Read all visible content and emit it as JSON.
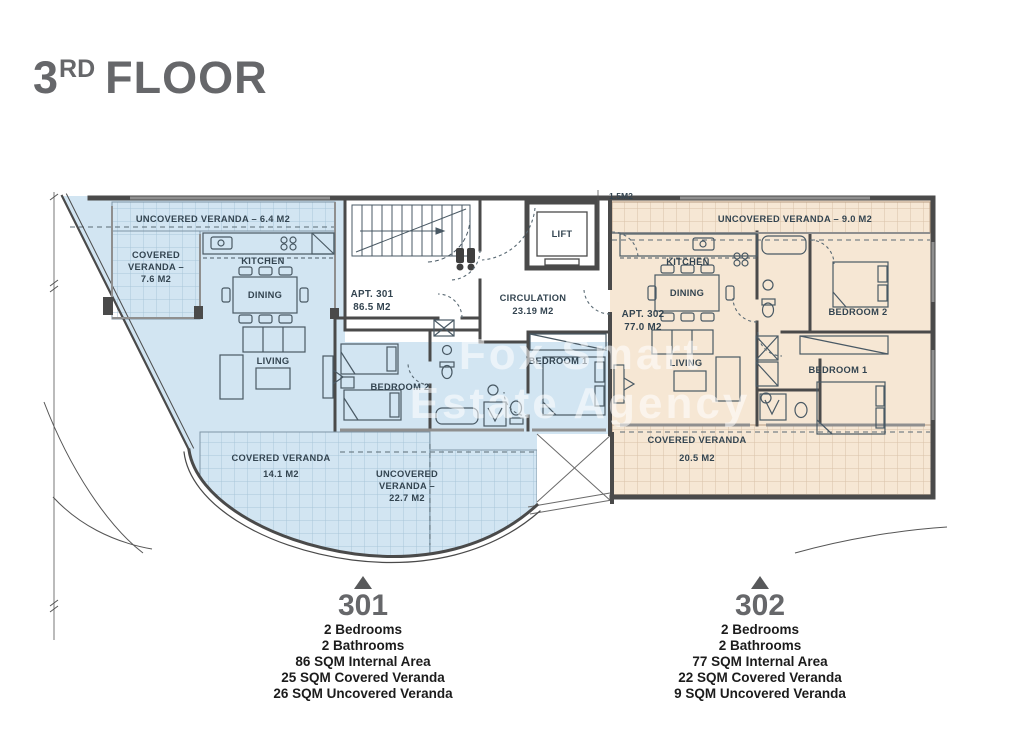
{
  "title": {
    "number": "3",
    "ordinal": "RD",
    "word": "FLOOR"
  },
  "watermark": {
    "line1": "Fox Smart",
    "line2": "Estate Agency"
  },
  "core": {
    "lift": "LIFT",
    "circulation_line1": "CIRCULATION",
    "circulation_line2": "23.19 M2",
    "dim_label": "1.5M2"
  },
  "apt301": {
    "veranda_top": "UNCOVERED VERANDA – 6.4 M2",
    "covered_veranda_l1": "COVERED",
    "covered_veranda_l2": "VERANDA –",
    "covered_veranda_l3": "7.6 M2",
    "kitchen": "KITCHEN",
    "dining": "DINING",
    "apt_l1": "APT. 301",
    "apt_l2": "86.5 M2",
    "living": "LIVING",
    "bedroom1": "BEDROOM 1",
    "bedroom2": "BEDROOM 2",
    "covered_bottom_l1": "COVERED VERANDA",
    "covered_bottom_l2": "14.1 M2",
    "uncovered_bottom_l1": "UNCOVERED",
    "uncovered_bottom_l2": "VERANDA –",
    "uncovered_bottom_l3": "22.7 M2"
  },
  "apt302": {
    "veranda_top": "UNCOVERED VERANDA – 9.0 M2",
    "kitchen": "KITCHEN",
    "dining": "DINING",
    "apt_l1": "APT. 302",
    "apt_l2": "77.0 M2",
    "living": "LIVING",
    "bedroom1": "BEDROOM 1",
    "bedroom2": "BEDROOM 2",
    "covered_bottom_l1": "COVERED VERANDA",
    "covered_bottom_l2": "20.5 M2"
  },
  "legend": {
    "units": [
      {
        "number": "301",
        "lines": [
          "2 Bedrooms",
          "2 Bathrooms",
          "86 SQM Internal Area",
          "25 SQM Covered Veranda",
          "26 SQM Uncovered Veranda"
        ]
      },
      {
        "number": "302",
        "lines": [
          "2 Bedrooms",
          "2 Bathrooms",
          "77 SQM Internal Area",
          "22 SQM Covered Veranda",
          "9 SQM Uncovered Veranda"
        ]
      }
    ]
  },
  "colors": {
    "apt301_fill": "#d2e5f2",
    "apt302_fill": "#f6e7d4",
    "wall": "#4a4a4a",
    "label_text": "#334450",
    "title_text": "#66676a",
    "legend_text": "#1c1c1c"
  }
}
